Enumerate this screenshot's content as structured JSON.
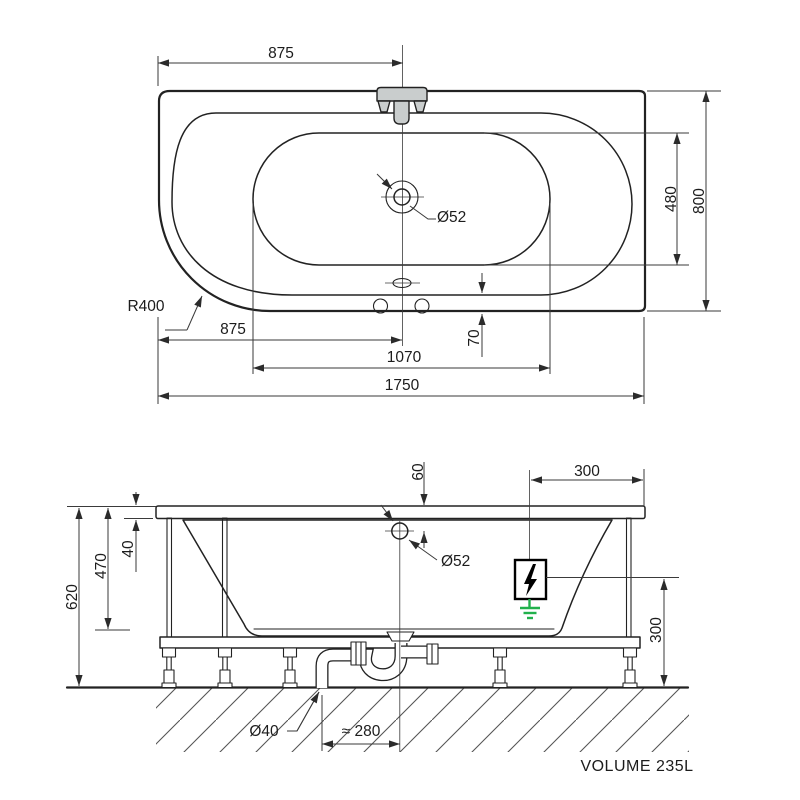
{
  "top_view": {
    "dims": {
      "faucet_offset": "875",
      "overall_depth": "800",
      "basin_depth": "480",
      "corner_radius": "R400",
      "drain_offset": "875",
      "basin_length": "1070",
      "overall_length": "1750",
      "rim_inset": "70",
      "drain_diameter": "Ø52"
    }
  },
  "front_view": {
    "dims": {
      "drain_from_rim": "60",
      "equipotential_box_offset": "300",
      "rim_thickness": "40",
      "basin_height": "470",
      "overall_height": "620",
      "drain_diameter": "Ø52",
      "box_height_above_floor": "300",
      "waste_pipe_diameter": "Ø40",
      "trap_offset": "≈ 280"
    }
  },
  "footer": {
    "volume_label": "VOLUME 235L"
  },
  "colors": {
    "paper": "#ffffff",
    "line": "#222222",
    "dim_line": "#3a3a3a",
    "text": "#1c1c1c",
    "tub_fill": "#e9ebeb",
    "fixture_fill": "#c9cdcd",
    "ground_green": "#22b14c"
  }
}
